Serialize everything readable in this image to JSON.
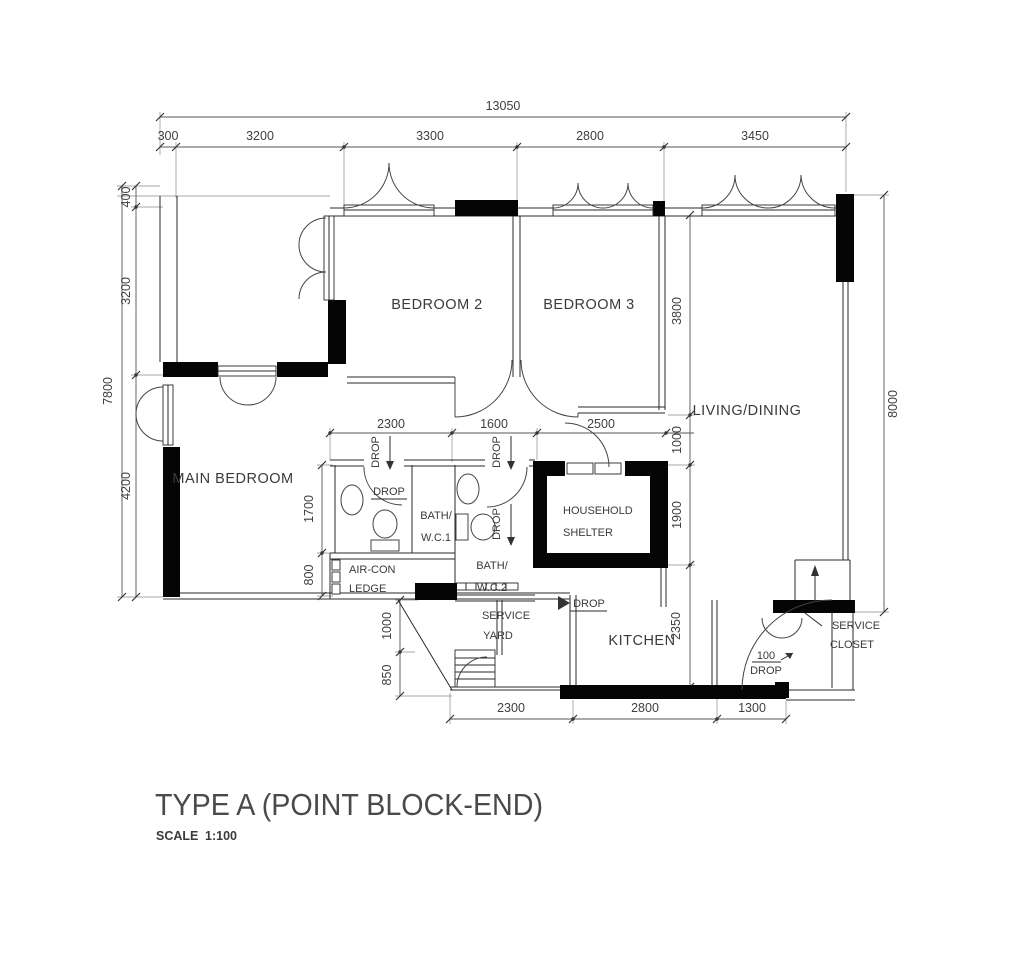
{
  "title": {
    "name": "TYPE A (POINT BLOCK-END)",
    "scale_label": "SCALE",
    "scale_value": "1:100"
  },
  "rooms": {
    "bedroom2": "BEDROOM 2",
    "bedroom3": "BEDROOM 3",
    "living_dining": "LIVING/DINING",
    "main_bedroom": "MAIN BEDROOM",
    "bath_wc1_line1": "BATH/",
    "bath_wc1_line2": "W.C.1",
    "bath_wc2_line1": "BATH/",
    "bath_wc2_line2": "W.C.2",
    "household_shelter_line1": "HOUSEHOLD",
    "household_shelter_line2": "SHELTER",
    "aircon_ledge_line1": "AIR-CON",
    "aircon_ledge_line2": "LEDGE",
    "service_yard_line1": "SERVICE",
    "service_yard_line2": "YARD",
    "kitchen": "KITCHEN",
    "service_closet_line1": "SERVICE",
    "service_closet_line2": "CLOSET"
  },
  "dimensions": {
    "top_total": "13050",
    "top_segments": [
      "300",
      "3200",
      "3300",
      "2800",
      "3450"
    ],
    "left_total": "7800",
    "left_segments": [
      "400",
      "3200",
      "4200"
    ],
    "right_total": "8000",
    "right_inner": [
      "3800",
      "1000",
      "1900",
      "2350"
    ],
    "mid_segments": [
      "2300",
      "1600",
      "2500"
    ],
    "bath_inner": [
      "1700",
      "800"
    ],
    "yard_inner": [
      "1000",
      "850"
    ],
    "bottom_segments": [
      "2300",
      "2800",
      "1300"
    ]
  },
  "annotations": {
    "drop": "DROP",
    "drop_100_value": "100",
    "drop_100_label": "DROP"
  },
  "colors": {
    "wall": "#050505",
    "line": "#2a2a2a",
    "text": "#3a3a3a",
    "background": "#ffffff"
  }
}
